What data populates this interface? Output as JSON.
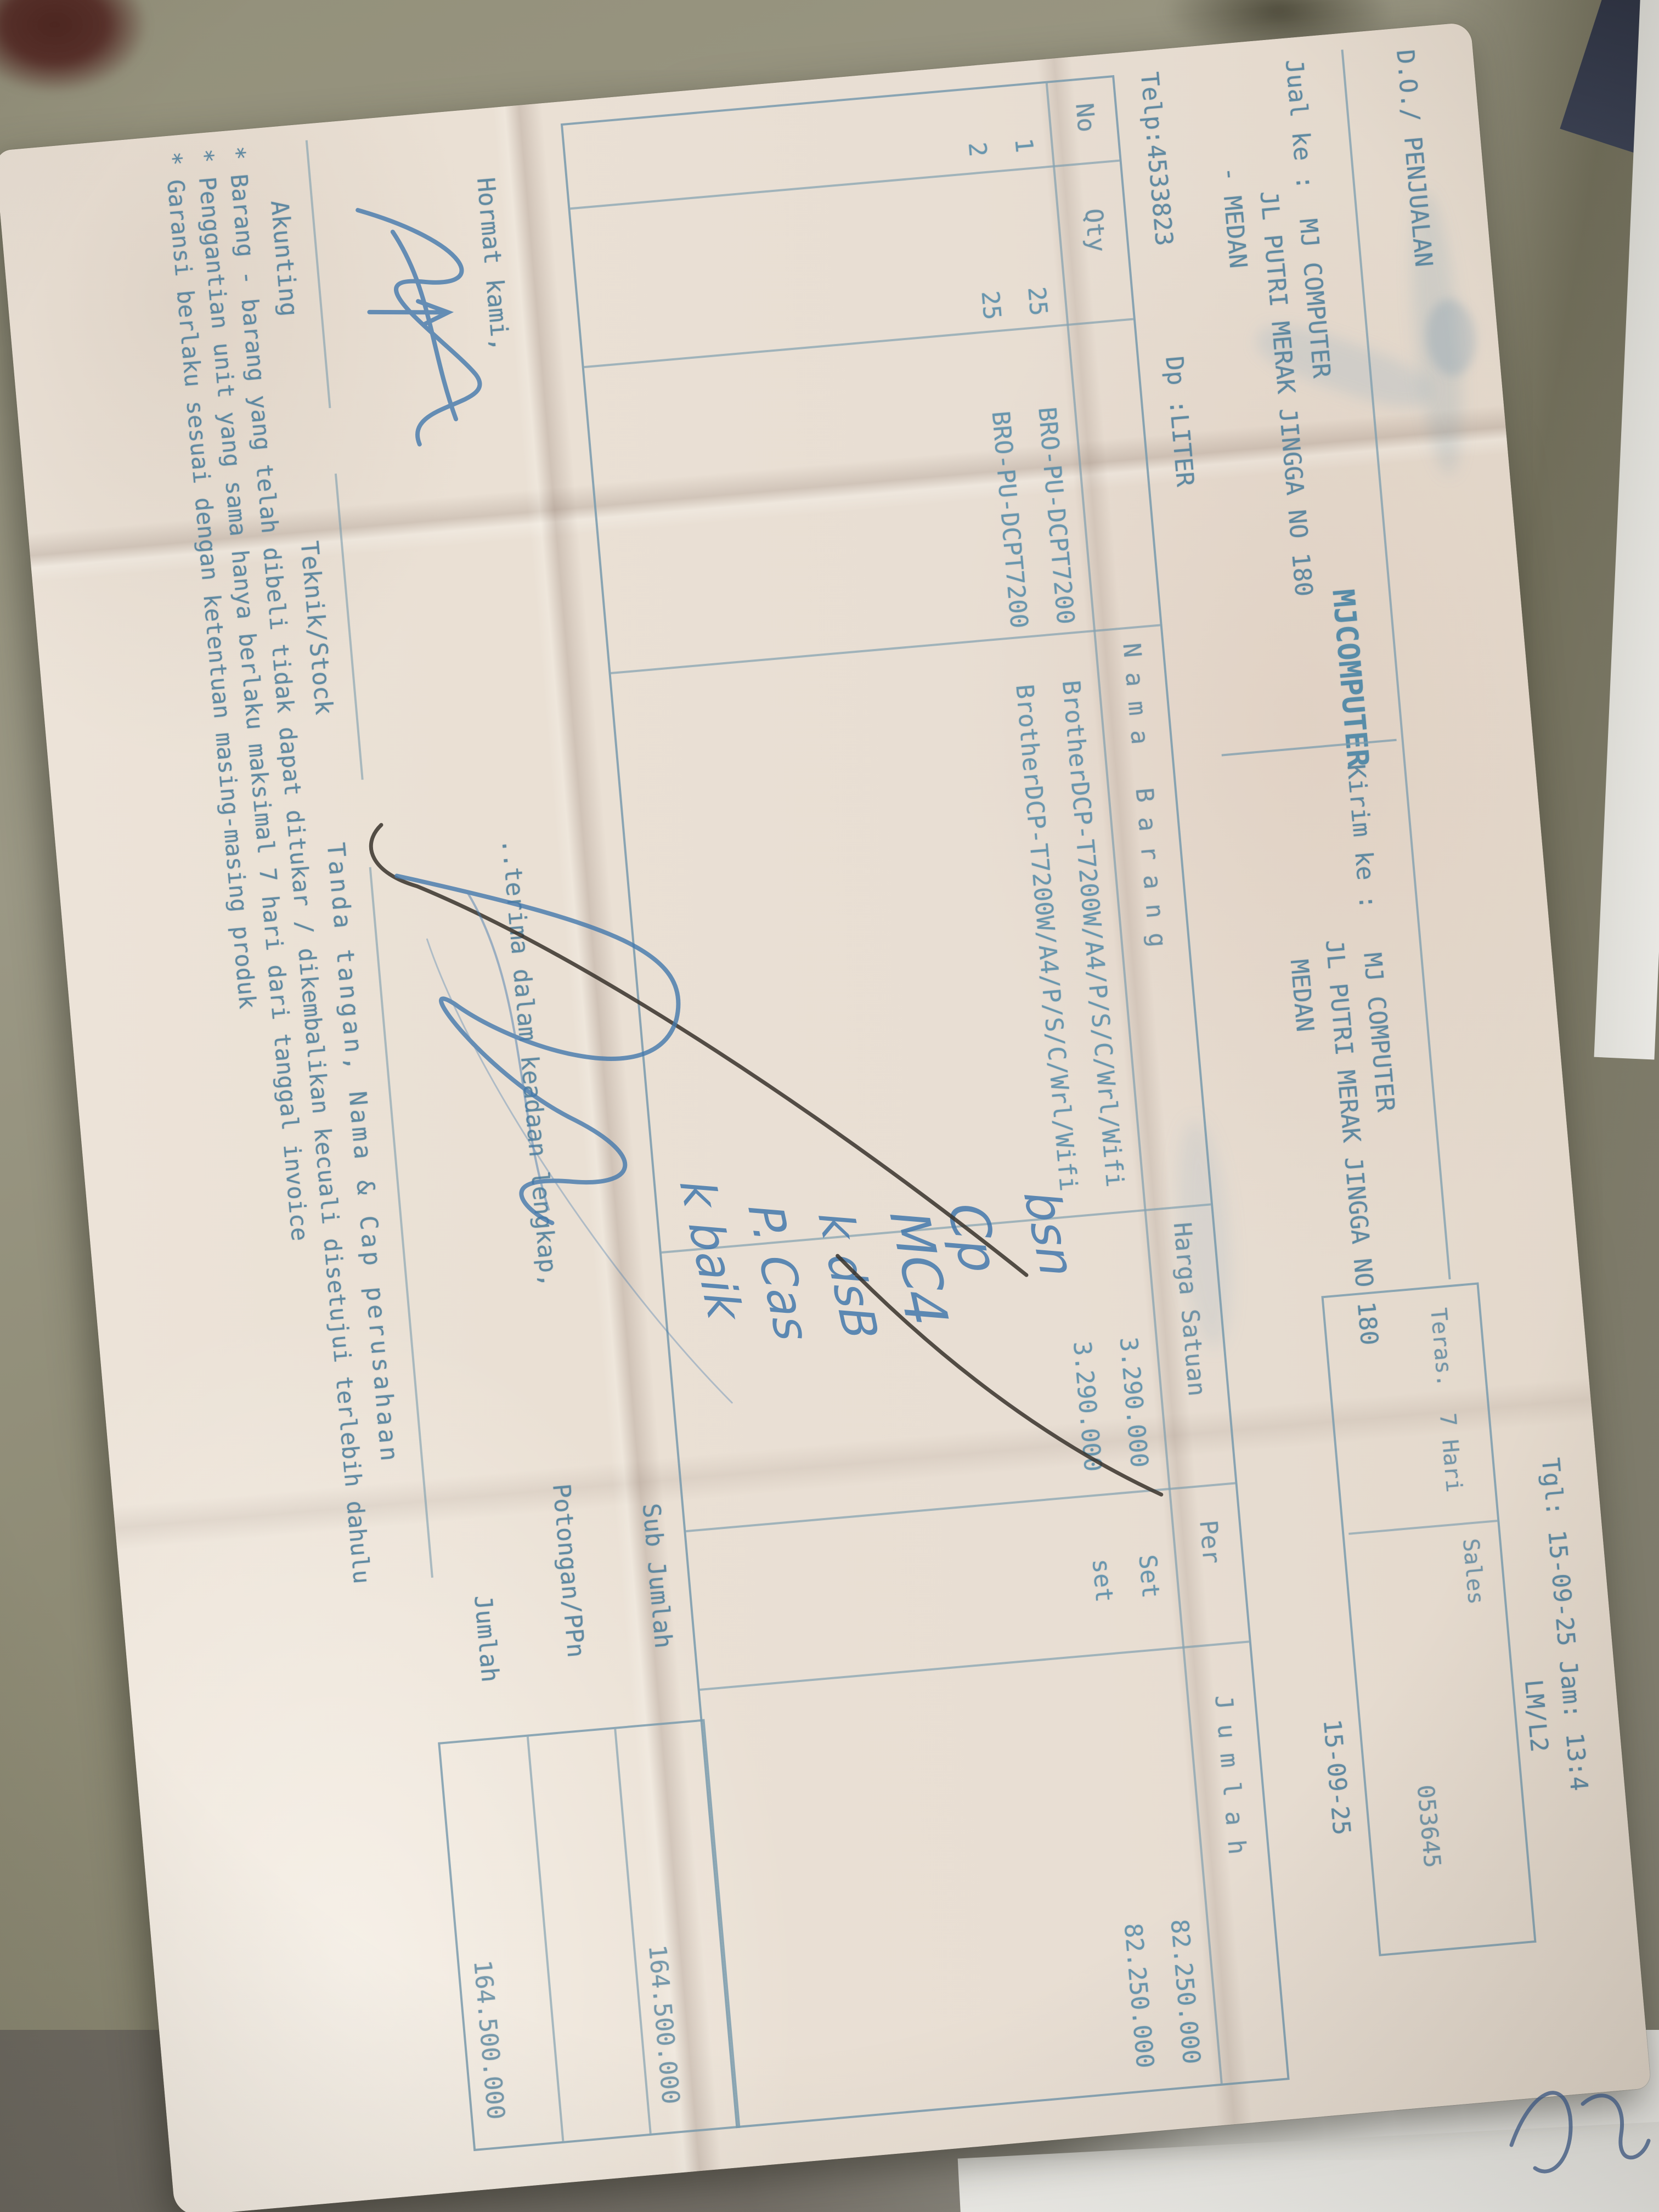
{
  "header": {
    "doc_title": "D.O./ PENJUALAN",
    "company": "MJCOMPUTER",
    "datetime_line": "Tgl: 15-09-25 Jam: 13:4",
    "operator_code": "LM/L2",
    "jual_ke_line": "Jual ke :  MJ COMPUTER",
    "jual_ke_address": "JL PUTRI MERAK JINGGA NO 180",
    "jual_ke_city": "- MEDAN",
    "kirim_ke_line": "Kirim ke :   MJ COMPUTER",
    "kirim_ke_address": "JL PUTRI MERAK JINGGA NO 180",
    "kirim_ke_city": "MEDAN",
    "telp": "Telp:4533823",
    "dp_field": "Dp :LITER"
  },
  "terms_box": {
    "term": "Teras.  7 Hari",
    "sales_label": "Sales",
    "doc_number": "053645",
    "date_below": "15-09-25"
  },
  "table": {
    "headers": {
      "no": "No",
      "qty": "Qty",
      "name": "N a m a   B a r a n g",
      "price": "Harga Satuan",
      "per": "Per",
      "amount": "J u m l a h"
    },
    "rows": [
      {
        "no": "1",
        "qty": "25",
        "code": "BRO-PU-DCPT7200",
        "name": "BrotherDCP-T7200W/A4/P/S/C/Wrl/Wifi",
        "price": "3.290.000",
        "per": "Set",
        "amount": "82.250.000"
      },
      {
        "no": "2",
        "qty": "25",
        "code": "BRO-PU-DCPT7200",
        "name": "BrotherDCP-T7200W/A4/P/S/C/Wrl/Wifi",
        "price": "3.290.000",
        "per": "set",
        "amount": "82.250.000"
      }
    ]
  },
  "summary": {
    "sub_jumlah_label": "Sub Jumlah",
    "sub_jumlah_value": "164.500.000",
    "potongan_label": "Potongan/PPn",
    "potongan_value": "",
    "jumlah_label": "Jumlah",
    "jumlah_value": "164.500.000"
  },
  "signature_section": {
    "hormat_kami": "Hormat kami,",
    "terima_note": "..terima dalam keadaan lengkap,",
    "akunting": "Akunting",
    "teknik_stock": "Teknik/Stock",
    "tanda_tangan": "Tanda tangan, Nama & Cap perusahaan"
  },
  "notes": [
    "* Barang - barang yang telah dibeli tidak dapat ditukar / dikembalikan kecuali disetujui terlebih dahulu",
    "* Penggantian unit yang sama hanya berlaku maksimal 7 hari dari tanggal invoice",
    "* Garansi berlaku sesuai dengan ketentuan masing-masing produk"
  ],
  "handwriting": {
    "note1": "bsn",
    "note2": "Cp",
    "note3": "MC",
    "note4": "4",
    "note5": "k dsB",
    "note6": "P. Cas",
    "note7": "k baik"
  },
  "colors": {
    "ink": "#57849e",
    "line": "#7b9cae",
    "paper": "#e7ddd2",
    "pen_black": "#38332c",
    "pen_blue": "#4479ad",
    "surface": "#8e8b75"
  }
}
